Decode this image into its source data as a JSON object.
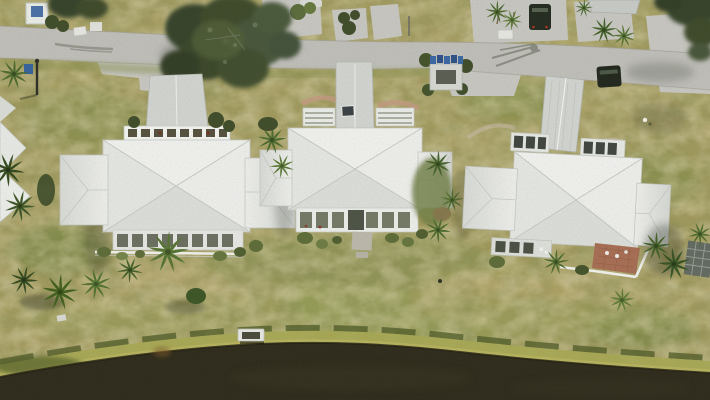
{
  "meta": {
    "type": "aerial-drone-photograph",
    "orientation": "top-down"
  },
  "scene": {
    "description": "Top-down aerial drone photo of three coastal homes with white cross-hip roofs set between a gray residential street at the top and a dark pond with a grassy bank at the bottom, surrounded by sun-dried mottled lawn, palm trees and a large live oak.",
    "objects": [
      "residential street",
      "concrete driveways",
      "large live oak canopy",
      "palm trees",
      "left house with white hip roof and screened porch",
      "center house with white hip roof and skylight",
      "right house with silver metal roof and brick patio",
      "screened lanais",
      "white perimeter railing",
      "blue trash and recycling bins",
      "white mail kiosk",
      "parked dark SUV",
      "dark SUV on street",
      "white car at street edge",
      "pond with dark water",
      "bright green shore band",
      "small white dock",
      "white wading bird"
    ]
  },
  "palette": {
    "grass_base": "#a59c60",
    "grass_green": "#7f8a48",
    "grass_tan": "#b7a871",
    "road_gray": "#c1c0bc",
    "driveway_gray": "#c9c8c4",
    "water_dark": "#2e2a1c",
    "shore_green": "#a9aa54",
    "shore_dark_band": "#4e5a27",
    "roof_white": "#f3f4f2",
    "roof_silver": "#d3d6d3",
    "oak_green": "#3d492c",
    "palm_green": "#567434",
    "bin_blue": "#3a67a5",
    "brick_red": "#a86e55",
    "car_dark": "#232a20"
  }
}
